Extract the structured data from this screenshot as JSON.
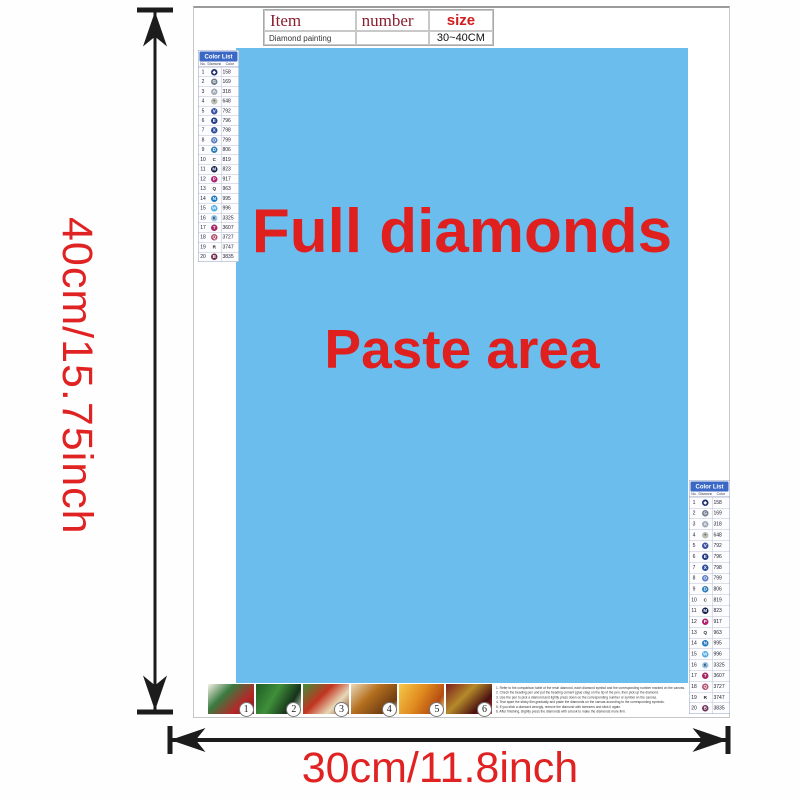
{
  "dimensions": {
    "height_label": "40cm/15.75inch",
    "width_label": "30cm/11.8inch"
  },
  "item_table": {
    "col_item": "Item",
    "col_number": "number",
    "col_size": "size",
    "row_item": "Diamond painting",
    "row_number": "",
    "row_size": "30~40CM"
  },
  "paste_area": {
    "line1": "Full diamonds",
    "line2": "Paste area",
    "bg_color": "#6bbdee",
    "text_color": "#e01f1f"
  },
  "color_list": {
    "title": "Color List",
    "col_no": "No.",
    "col_diamond": "Diamond",
    "col_color": "Color",
    "header_bg": "#3a68c4",
    "rows": [
      {
        "no": "1",
        "code": "158",
        "glyph": "◆",
        "bg": "#1b2d6d",
        "fg": "#ffffff"
      },
      {
        "no": "2",
        "code": "169",
        "glyph": "G",
        "bg": "#6f7d8c",
        "fg": "#ffffff"
      },
      {
        "no": "3",
        "code": "318",
        "glyph": "A",
        "bg": "#9fa9b4",
        "fg": "#ffffff"
      },
      {
        "no": "4",
        "code": "648",
        "glyph": "+",
        "bg": "#b9bdb2",
        "fg": "#555555"
      },
      {
        "no": "5",
        "code": "792",
        "glyph": "V",
        "bg": "#3952a5",
        "fg": "#ffffff"
      },
      {
        "no": "6",
        "code": "796",
        "glyph": "E",
        "bg": "#203a86",
        "fg": "#ffffff"
      },
      {
        "no": "7",
        "code": "798",
        "glyph": "X",
        "bg": "#2a4e9d",
        "fg": "#ffffff"
      },
      {
        "no": "8",
        "code": "799",
        "glyph": "O",
        "bg": "#5b7ec4",
        "fg": "#ffffff"
      },
      {
        "no": "9",
        "code": "806",
        "glyph": "D",
        "bg": "#2d7cba",
        "fg": "#ffffff"
      },
      {
        "no": "10",
        "code": "819",
        "glyph": "C",
        "bg": "transparent",
        "fg": "#222222"
      },
      {
        "no": "11",
        "code": "823",
        "glyph": "M",
        "bg": "#151f4e",
        "fg": "#ffffff"
      },
      {
        "no": "12",
        "code": "917",
        "glyph": "P",
        "bg": "#b02070",
        "fg": "#ffffff"
      },
      {
        "no": "13",
        "code": "963",
        "glyph": "Q",
        "bg": "transparent",
        "fg": "#222222"
      },
      {
        "no": "14",
        "code": "995",
        "glyph": "N",
        "bg": "#1f78c0",
        "fg": "#ffffff"
      },
      {
        "no": "15",
        "code": "996",
        "glyph": "W",
        "bg": "#47a9e2",
        "fg": "#ffffff"
      },
      {
        "no": "16",
        "code": "3325",
        "glyph": "K",
        "bg": "#9cc6e8",
        "fg": "#1a3550"
      },
      {
        "no": "17",
        "code": "3607",
        "glyph": "T",
        "bg": "#a52565",
        "fg": "#ffffff"
      },
      {
        "no": "18",
        "code": "3727",
        "glyph": "Q",
        "bg": "#b0506e",
        "fg": "#ffffff"
      },
      {
        "no": "19",
        "code": "3747",
        "glyph": "R",
        "bg": "transparent",
        "fg": "#222222"
      },
      {
        "no": "20",
        "code": "3835",
        "glyph": "B",
        "bg": "#6e2f55",
        "fg": "#ffffff"
      }
    ]
  },
  "steps": [
    {
      "num": "1",
      "gradient": "linear-gradient(135deg,#f5f2e8 0%,#3a7a40 35%,#b42828 70%,#7a1e1e 100%)"
    },
    {
      "num": "2",
      "gradient": "linear-gradient(120deg,#1e5c24 0%,#3f8f3a 40%,#16331a 75%,#dfe8d0 100%)"
    },
    {
      "num": "3",
      "gradient": "linear-gradient(135deg,#3f8f3a 0%,#c23420 40%,#e8d9b8 70%,#8f4a20 100%)"
    },
    {
      "num": "4",
      "gradient": "linear-gradient(135deg,#e8d9b8 0%,#b5701f 40%,#6e3c12 80%,#f2e8d0 100%)"
    },
    {
      "num": "5",
      "gradient": "linear-gradient(120deg,#f5c84a 0%,#e08a1e 45%,#b54d12 80%,#f8e2a0 100%)"
    },
    {
      "num": "6",
      "gradient": "linear-gradient(135deg,#7a1e1e 0%,#b58a2a 40%,#4a1010 75%,#c23420 100%)"
    }
  ],
  "instructions": [
    "1. Refer to the comparison table of the resin diamond, each diamond symbol and the corresponding number marked on the canvas.",
    "2. Check the beading pen and put the beading cement (glue clay) on the tip of the pen, then pick up the diamond.",
    "3. Use the pen to pick a diamond and lightly press down on the corresponding number or symbol on the canvas.",
    "4. Tear apart the sticky film gradually and paste the diamonds on the canvas according to the corresponding symbols.",
    "5. If you stick a diamond wrongly, remove the diamond with tweezers and stick it again.",
    "6. After finishing, slightly press the diamonds with a book to make the diamonds more firm."
  ]
}
